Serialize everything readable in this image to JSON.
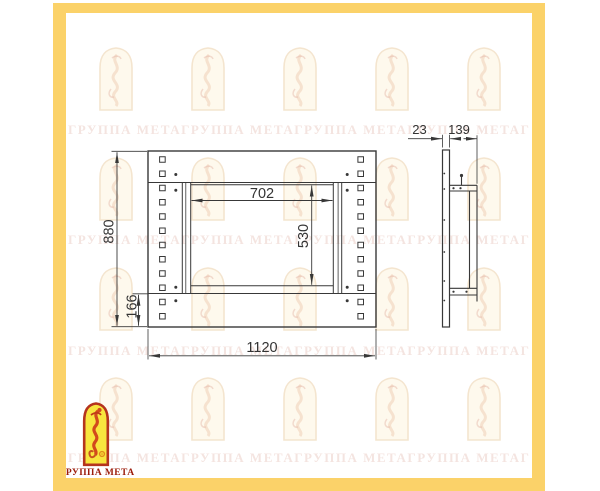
{
  "frame": {
    "color": "#fbd269"
  },
  "watermark": {
    "brand": "ГРУППА МЕТА",
    "row_text": "ГРУППА МЕТАГРУППА МЕТАГРУППА МЕТАГРУППА МЕТАГРУППА МЕТАГРУППА МЕТА",
    "text_color": "#c67a64",
    "arch_icon": "firebird-arch-watermark"
  },
  "logo": {
    "caption": "ГРУППА МЕТА",
    "emblem_icon": "firebird-arch-emblem",
    "border_color": "#b5341d",
    "fill_color": "#f8e53e",
    "caption_color": "#9c1d0c"
  },
  "drawing": {
    "line_color": "#383838",
    "front_view": {
      "overall_width": "1120",
      "overall_height": "880",
      "opening_width": "702",
      "opening_height": "530",
      "bottom_rail_height": "166"
    },
    "side_view": {
      "panel_thickness": "23",
      "frame_depth": "139"
    }
  }
}
